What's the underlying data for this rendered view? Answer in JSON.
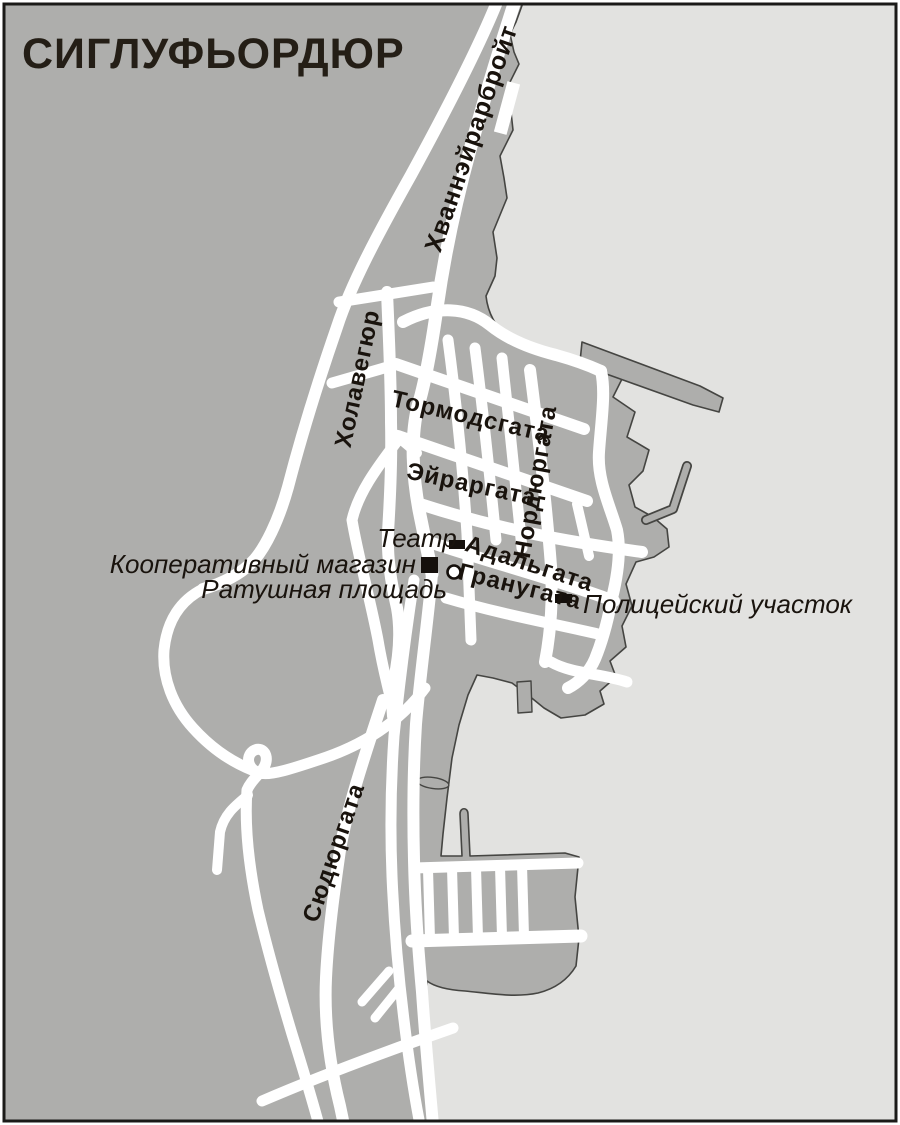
{
  "map": {
    "title": "СИГЛУФЬОРДЮР",
    "colors": {
      "land": "#aeaeac",
      "water": "#e2e2e0",
      "road": "#ffffff",
      "coastline": "#454542",
      "text": "#19130d",
      "frame": "#1b1a18",
      "marker": "#15100c"
    },
    "streets": [
      {
        "name": "Хваннэйрарбройт"
      },
      {
        "name": "Холавегюр"
      },
      {
        "name": "Тормодсгата"
      },
      {
        "name": "Эйраргата"
      },
      {
        "name": "Нордюргата"
      },
      {
        "name": "Адальгата"
      },
      {
        "name": "Гранугата"
      },
      {
        "name": "Сюдюргата"
      }
    ],
    "landmarks": [
      {
        "name": "Театр",
        "marker": "building-rect"
      },
      {
        "name": "Кооперативный магазин",
        "marker": "building-square"
      },
      {
        "name": "Ратушная площадь",
        "marker": "circle"
      },
      {
        "name": "Полицейский участок",
        "marker": "building-rect"
      }
    ]
  }
}
